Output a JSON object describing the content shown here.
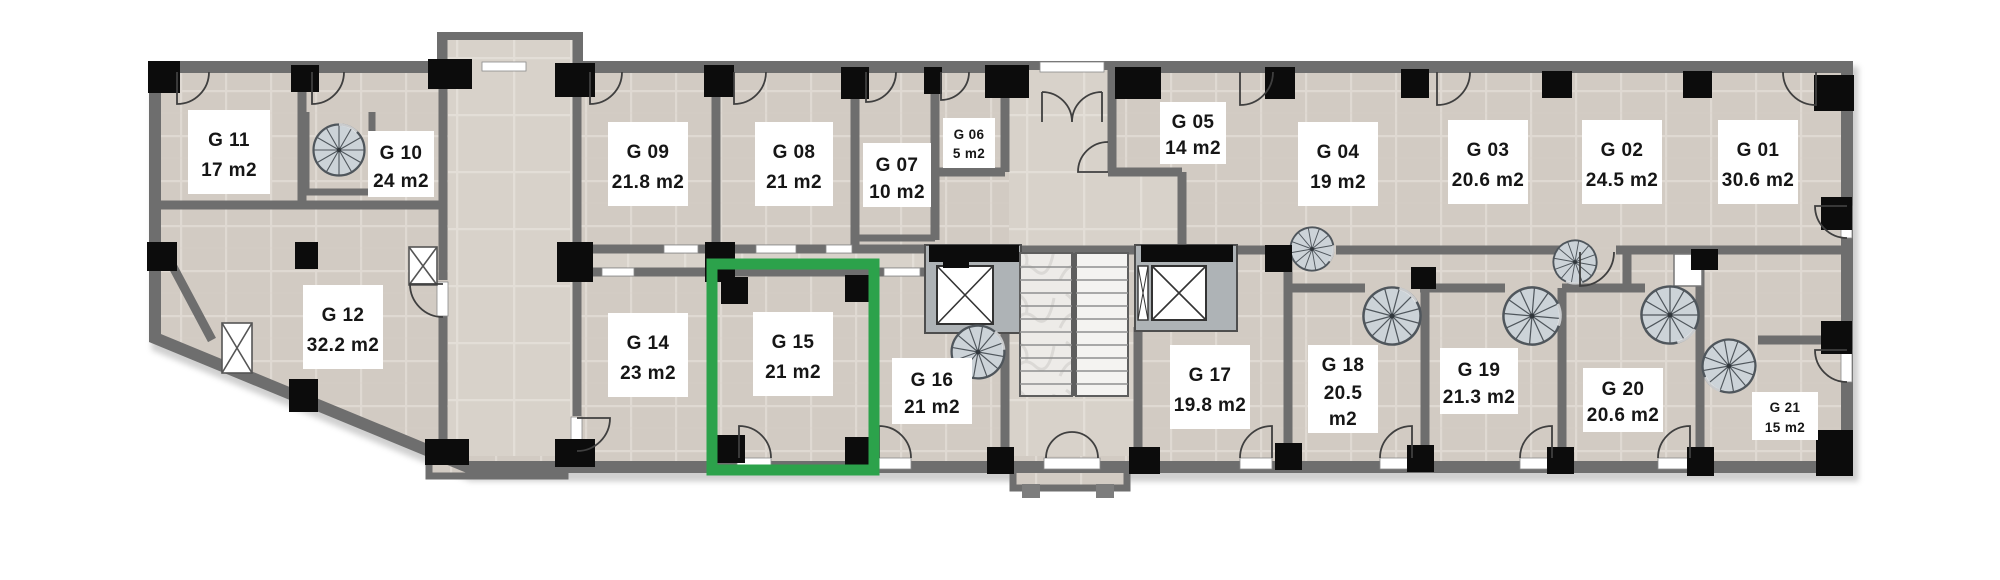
{
  "floorplan": {
    "background": "#ffffff",
    "palette": {
      "floor": "#d2cbc3",
      "floor_grout": "#dfd9d2",
      "hall_floor": "#d8d2ca",
      "wall": "#6e6e6e",
      "column": "#0c0c0c",
      "label_bg": "#ffffff",
      "label_text": "#161616",
      "stair_fill": "#ccd3d8",
      "marble": "#edebe8",
      "highlight": "#2ca24b"
    },
    "highlight": {
      "room": "G 15",
      "color": "#2ca24b"
    },
    "fixtures": {
      "elevators": 2,
      "spiral_staircases": 8,
      "central_staircase": true,
      "entrance_doors": 2
    },
    "rooms": [
      {
        "id": "g01",
        "lines": [
          "G 01",
          "30.6 m2"
        ],
        "highlighted": false
      },
      {
        "id": "g02",
        "lines": [
          "G 02",
          "24.5 m2"
        ],
        "highlighted": false
      },
      {
        "id": "g03",
        "lines": [
          "G 03",
          "20.6 m2"
        ],
        "highlighted": false
      },
      {
        "id": "g04",
        "lines": [
          "G 04",
          "19 m2"
        ],
        "highlighted": false
      },
      {
        "id": "g05",
        "lines": [
          "G 05",
          "14 m2"
        ],
        "highlighted": false
      },
      {
        "id": "g06",
        "lines": [
          "G 06",
          "5 m2"
        ],
        "highlighted": false
      },
      {
        "id": "g07",
        "lines": [
          "G 07",
          "10 m2"
        ],
        "highlighted": false
      },
      {
        "id": "g08",
        "lines": [
          "G 08",
          "21 m2"
        ],
        "highlighted": false
      },
      {
        "id": "g09",
        "lines": [
          "G 09",
          "21.8 m2"
        ],
        "highlighted": false
      },
      {
        "id": "g10",
        "lines": [
          "G 10",
          "24 m2"
        ],
        "highlighted": false
      },
      {
        "id": "g11",
        "lines": [
          "G 11",
          "17 m2"
        ],
        "highlighted": false
      },
      {
        "id": "g12",
        "lines": [
          "G 12",
          "32.2 m2"
        ],
        "highlighted": false
      },
      {
        "id": "g14",
        "lines": [
          "G 14",
          "23 m2"
        ],
        "highlighted": false
      },
      {
        "id": "g15",
        "lines": [
          "G 15",
          "21 m2"
        ],
        "highlighted": true
      },
      {
        "id": "g16",
        "lines": [
          "G 16",
          "21 m2"
        ],
        "highlighted": false
      },
      {
        "id": "g17",
        "lines": [
          "G 17",
          "19.8 m2"
        ],
        "highlighted": false
      },
      {
        "id": "g18",
        "lines": [
          "G 18",
          "20.5",
          "m2"
        ],
        "highlighted": false
      },
      {
        "id": "g19",
        "lines": [
          "G 19",
          "21.3 m2"
        ],
        "highlighted": false
      },
      {
        "id": "g20",
        "lines": [
          "G 20",
          "20.6 m2"
        ],
        "highlighted": false
      },
      {
        "id": "g21",
        "lines": [
          "G 21",
          "15 m2"
        ],
        "highlighted": false
      }
    ]
  }
}
